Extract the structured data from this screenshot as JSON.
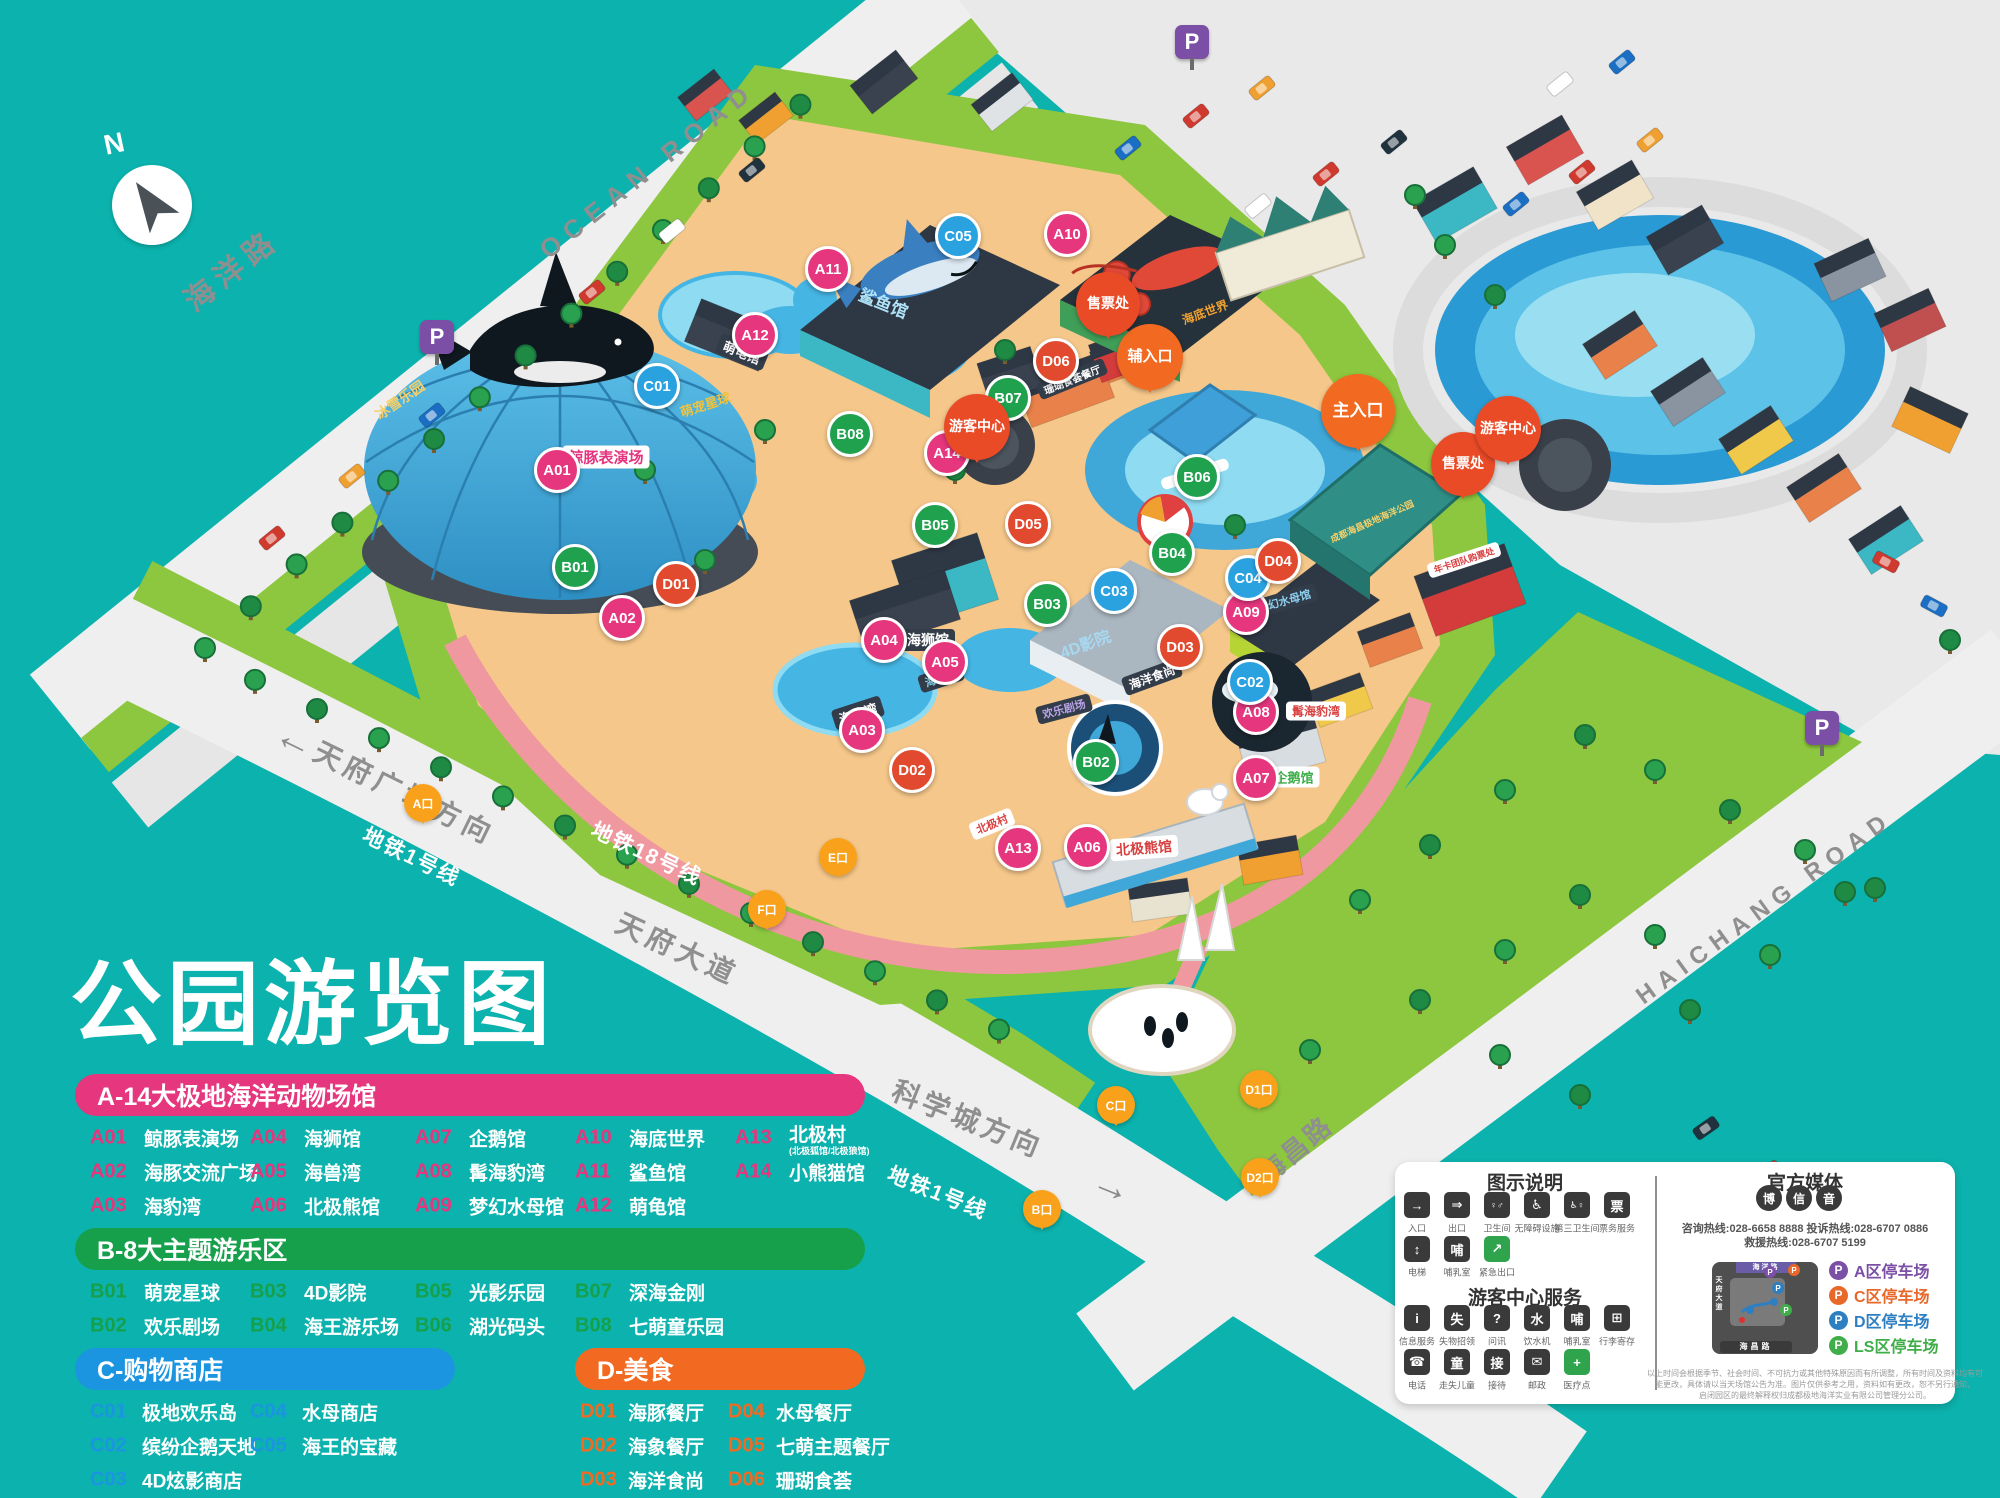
{
  "title": "公园游览图",
  "compass": {
    "north_label": "N"
  },
  "roads": {
    "ocean_road_cn": "海洋路",
    "ocean_road_en": "OCEAN ROAD",
    "haichang_road_cn": "海昌路",
    "haichang_road_en": "HAICHANG ROAD",
    "tianfu_avenue": "天府大道",
    "tianfu_square_direction": "天府广场方向",
    "science_city_direction": "科学城方向",
    "metro_line1": "地铁1号线",
    "metro_line18": "地铁18号线"
  },
  "map": {
    "marker_colors": {
      "A": "#e5367e",
      "B": "#1fa14e",
      "C": "#2aa2e0",
      "D": "#e14a2e"
    },
    "balloons": [
      {
        "label": "主入口",
        "x": 1358,
        "y": 448,
        "kind": "entrance",
        "size": 66,
        "fs": 17
      },
      {
        "label": "辅入口",
        "x": 1150,
        "y": 390,
        "kind": "entrance",
        "size": 58,
        "fs": 15
      },
      {
        "label": "售票处",
        "x": 1463,
        "y": 496,
        "kind": "service",
        "size": 56,
        "fs": 14
      },
      {
        "label": "售票处",
        "x": 1108,
        "y": 336,
        "kind": "service",
        "size": 56,
        "fs": 14
      },
      {
        "label": "游客中心",
        "x": 1508,
        "y": 462,
        "kind": "service",
        "size": 58,
        "fs": 14
      },
      {
        "label": "游客中心",
        "x": 977,
        "y": 460,
        "kind": "service",
        "size": 58,
        "fs": 14
      }
    ],
    "metro_exits": [
      {
        "label": "A口",
        "x": 423,
        "y": 822
      },
      {
        "label": "B口",
        "x": 1042,
        "y": 1228
      },
      {
        "label": "C口",
        "x": 1116,
        "y": 1124
      },
      {
        "label": "D1口",
        "x": 1259,
        "y": 1108
      },
      {
        "label": "D2口",
        "x": 1260,
        "y": 1196
      },
      {
        "label": "E口",
        "x": 838,
        "y": 876
      },
      {
        "label": "F口",
        "x": 767,
        "y": 928
      }
    ],
    "parking_signs": [
      {
        "label": "P",
        "x": 1192,
        "y": 42
      },
      {
        "label": "P",
        "x": 437,
        "y": 337
      },
      {
        "label": "P",
        "x": 1822,
        "y": 728
      }
    ],
    "markers": [
      {
        "code": "A01",
        "cat": "A",
        "x": 557,
        "y": 470
      },
      {
        "code": "A02",
        "cat": "A",
        "x": 622,
        "y": 618
      },
      {
        "code": "A03",
        "cat": "A",
        "x": 862,
        "y": 730
      },
      {
        "code": "A04",
        "cat": "A",
        "x": 884,
        "y": 640
      },
      {
        "code": "A05",
        "cat": "A",
        "x": 945,
        "y": 662
      },
      {
        "code": "A06",
        "cat": "A",
        "x": 1087,
        "y": 847
      },
      {
        "code": "A07",
        "cat": "A",
        "x": 1256,
        "y": 778
      },
      {
        "code": "A08",
        "cat": "A",
        "x": 1256,
        "y": 712
      },
      {
        "code": "A09",
        "cat": "A",
        "x": 1246,
        "y": 612
      },
      {
        "code": "A10",
        "cat": "A",
        "x": 1067,
        "y": 234
      },
      {
        "code": "A11",
        "cat": "A",
        "x": 828,
        "y": 269
      },
      {
        "code": "A12",
        "cat": "A",
        "x": 755,
        "y": 335
      },
      {
        "code": "A13",
        "cat": "A",
        "x": 1018,
        "y": 848
      },
      {
        "code": "A14",
        "cat": "A",
        "x": 947,
        "y": 453
      },
      {
        "code": "B01",
        "cat": "B",
        "x": 575,
        "y": 567
      },
      {
        "code": "B02",
        "cat": "B",
        "x": 1096,
        "y": 762
      },
      {
        "code": "B03",
        "cat": "B",
        "x": 1047,
        "y": 604
      },
      {
        "code": "B04",
        "cat": "B",
        "x": 1172,
        "y": 553
      },
      {
        "code": "B05",
        "cat": "B",
        "x": 935,
        "y": 525
      },
      {
        "code": "B06",
        "cat": "B",
        "x": 1197,
        "y": 477
      },
      {
        "code": "B07",
        "cat": "B",
        "x": 1008,
        "y": 398
      },
      {
        "code": "B08",
        "cat": "B",
        "x": 850,
        "y": 434
      },
      {
        "code": "C01",
        "cat": "C",
        "x": 657,
        "y": 386
      },
      {
        "code": "C02",
        "cat": "C",
        "x": 1250,
        "y": 682
      },
      {
        "code": "C03",
        "cat": "C",
        "x": 1114,
        "y": 591
      },
      {
        "code": "C04",
        "cat": "C",
        "x": 1248,
        "y": 578
      },
      {
        "code": "C05",
        "cat": "C",
        "x": 958,
        "y": 236
      },
      {
        "code": "D01",
        "cat": "D",
        "x": 676,
        "y": 584
      },
      {
        "code": "D02",
        "cat": "D",
        "x": 912,
        "y": 770
      },
      {
        "code": "D03",
        "cat": "D",
        "x": 1180,
        "y": 647
      },
      {
        "code": "D04",
        "cat": "D",
        "x": 1278,
        "y": 561
      },
      {
        "code": "D05",
        "cat": "D",
        "x": 1028,
        "y": 524
      },
      {
        "code": "D06",
        "cat": "D",
        "x": 1056,
        "y": 361
      }
    ],
    "signs": [
      {
        "text": "鲸豚表演场",
        "x": 606,
        "y": 457,
        "rot": 0,
        "fg": "#e6357f",
        "bg": "#ffffff",
        "fs": 15
      },
      {
        "text": "冰雪乐园",
        "x": 400,
        "y": 400,
        "rot": -35,
        "fg": "#f5d06a",
        "bg": "",
        "fs": 14
      },
      {
        "text": "萌宠星球",
        "x": 705,
        "y": 404,
        "rot": -18,
        "fg": "#f0c23e",
        "bg": "",
        "fs": 13
      },
      {
        "text": "萌龟馆",
        "x": 742,
        "y": 352,
        "rot": 22,
        "fg": "#ffffff",
        "bg": "#333d4a",
        "fs": 13
      },
      {
        "text": "鲨鱼馆",
        "x": 884,
        "y": 302,
        "rot": 22,
        "fg": "#aee2f7",
        "bg": "",
        "fs": 17
      },
      {
        "text": "海底世界",
        "x": 1205,
        "y": 312,
        "rot": -20,
        "fg": "#f0a030",
        "bg": "",
        "fs": 12
      },
      {
        "text": "海狮馆",
        "x": 928,
        "y": 640,
        "rot": 0,
        "fg": "#ffffff",
        "bg": "#333d4a",
        "fs": 14
      },
      {
        "text": "海兽湾",
        "x": 941,
        "y": 678,
        "rot": -18,
        "fg": "#8edbf2",
        "bg": "#333d4a",
        "fs": 11
      },
      {
        "text": "海豹湾",
        "x": 858,
        "y": 713,
        "rot": -18,
        "fg": "#ffffff",
        "bg": "#333d4a",
        "fs": 13
      },
      {
        "text": "4D影院",
        "x": 1085,
        "y": 643,
        "rot": -20,
        "fg": "#a8d8f0",
        "bg": "",
        "fs": 16
      },
      {
        "text": "海洋食尚",
        "x": 1152,
        "y": 677,
        "rot": -20,
        "fg": "#ffffff",
        "bg": "#333d4a",
        "fs": 12
      },
      {
        "text": "梦幻水母馆",
        "x": 1284,
        "y": 601,
        "rot": -16,
        "fg": "#8ed0f0",
        "bg": "#333d4a",
        "fs": 11
      },
      {
        "text": "欢乐剧场",
        "x": 1064,
        "y": 709,
        "rot": -15,
        "fg": "#b9a3e8",
        "bg": "#333d4a",
        "fs": 11
      },
      {
        "text": "企鹅馆",
        "x": 1294,
        "y": 777,
        "rot": 0,
        "fg": "#3fae49",
        "bg": "#ffffff",
        "fs": 13
      },
      {
        "text": "髯海豹湾",
        "x": 1316,
        "y": 711,
        "rot": 0,
        "fg": "#d94040",
        "bg": "#ffffff",
        "fs": 12
      },
      {
        "text": "北极熊馆",
        "x": 1144,
        "y": 848,
        "rot": -4,
        "fg": "#d94040",
        "bg": "#ffffff",
        "fs": 14
      },
      {
        "text": "北极村",
        "x": 992,
        "y": 824,
        "rot": -22,
        "fg": "#d94040",
        "bg": "#ffffff",
        "fs": 11
      },
      {
        "text": "珊瑚食荟餐厅",
        "x": 1072,
        "y": 379,
        "rot": -22,
        "fg": "#ffffff",
        "bg": "#333d4a",
        "fs": 10
      },
      {
        "text": "成都海昌极地海洋公园",
        "x": 1372,
        "y": 521,
        "rot": -24,
        "fg": "#f5d06a",
        "bg": "",
        "fs": 9
      },
      {
        "text": "年卡团队购票处",
        "x": 1464,
        "y": 560,
        "rot": -18,
        "fg": "#d94040",
        "bg": "#ffffff",
        "fs": 9
      }
    ]
  },
  "legend": {
    "sections": [
      {
        "id": "A",
        "title": "A-14大极地海洋动物场馆",
        "color": "#e5367e",
        "x": 75,
        "y": 1074,
        "width": 790,
        "rows": 3,
        "cols": [
          15,
          175,
          340,
          500,
          660
        ],
        "name_offset": 54,
        "items": [
          {
            "code": "A01",
            "name": "鲸豚表演场"
          },
          {
            "code": "A02",
            "name": "海豚交流广场"
          },
          {
            "code": "A03",
            "name": "海豹湾"
          },
          {
            "code": "A04",
            "name": "海狮馆"
          },
          {
            "code": "A05",
            "name": "海兽湾"
          },
          {
            "code": "A06",
            "name": "北极熊馆"
          },
          {
            "code": "A07",
            "name": "企鹅馆"
          },
          {
            "code": "A08",
            "name": "髯海豹湾"
          },
          {
            "code": "A09",
            "name": "梦幻水母馆"
          },
          {
            "code": "A10",
            "name": "海底世界"
          },
          {
            "code": "A11",
            "name": "鲨鱼馆"
          },
          {
            "code": "A12",
            "name": "萌龟馆"
          },
          {
            "code": "A13",
            "name": "北极村",
            "note": "(北极狐馆/北极狼馆)"
          },
          {
            "code": "A14",
            "name": "小熊猫馆"
          }
        ]
      },
      {
        "id": "B",
        "title": "B-8大主题游乐区",
        "color": "#16a04c",
        "x": 75,
        "y": 1228,
        "width": 790,
        "rows": 2,
        "cols": [
          15,
          175,
          340,
          500
        ],
        "name_offset": 54,
        "items": [
          {
            "code": "B01",
            "name": "萌宠星球"
          },
          {
            "code": "B02",
            "name": "欢乐剧场"
          },
          {
            "code": "B03",
            "name": "4D影院"
          },
          {
            "code": "B04",
            "name": "海王游乐场"
          },
          {
            "code": "B05",
            "name": "光影乐园"
          },
          {
            "code": "B06",
            "name": "湖光码头"
          },
          {
            "code": "B07",
            "name": "深海金刚"
          },
          {
            "code": "B08",
            "name": "七萌童乐园"
          }
        ]
      },
      {
        "id": "C",
        "title": "C-购物商店",
        "color": "#1b95e0",
        "x": 75,
        "y": 1348,
        "width": 380,
        "rows": 3,
        "cols": [
          15,
          175
        ],
        "name_offset": 52,
        "items": [
          {
            "code": "C01",
            "name": "极地欢乐岛"
          },
          {
            "code": "C02",
            "name": "缤纷企鹅天地"
          },
          {
            "code": "C03",
            "name": "4D炫影商店"
          },
          {
            "code": "C04",
            "name": "水母商店"
          },
          {
            "code": "C05",
            "name": "海王的宝藏"
          }
        ]
      },
      {
        "id": "D",
        "title": "D-美食",
        "color": "#f26a21",
        "x": 575,
        "y": 1348,
        "width": 290,
        "rows": 3,
        "cols": [
          5,
          153
        ],
        "name_offset": 48,
        "items": [
          {
            "code": "D01",
            "name": "海豚餐厅"
          },
          {
            "code": "D02",
            "name": "海象餐厅"
          },
          {
            "code": "D03",
            "name": "海洋食尚"
          },
          {
            "code": "D04",
            "name": "水母餐厅"
          },
          {
            "code": "D05",
            "name": "七萌主题餐厅"
          },
          {
            "code": "D06",
            "name": "珊瑚食荟"
          }
        ]
      }
    ]
  },
  "panel": {
    "icon_legend": {
      "title": "图示说明",
      "items": [
        {
          "icon": "entrance-icon",
          "glyph": "→",
          "label": "入口"
        },
        {
          "icon": "exit-icon",
          "glyph": "⇒",
          "label": "出口"
        },
        {
          "icon": "restroom-icon",
          "glyph": "♀♂",
          "label": "卫生间"
        },
        {
          "icon": "accessible-icon",
          "glyph": "♿",
          "label": "无障碍设施"
        },
        {
          "icon": "third-restroom-icon",
          "glyph": "♿♀",
          "label": "第三卫生间"
        },
        {
          "icon": "ticket-service-icon",
          "glyph": "票",
          "label": "票务服务"
        },
        {
          "icon": "elevator-icon",
          "glyph": "↕",
          "label": "电梯"
        },
        {
          "icon": "nursing-room-icon",
          "glyph": "哺",
          "label": "哺乳室"
        },
        {
          "icon": "emergency-exit-icon",
          "glyph": "↗",
          "label": "紧急出口",
          "green": true
        }
      ]
    },
    "services": {
      "title": "游客中心服务",
      "items": [
        {
          "icon": "information-icon",
          "glyph": "i",
          "label": "信息服务"
        },
        {
          "icon": "lost-found-icon",
          "glyph": "失",
          "label": "失物招领"
        },
        {
          "icon": "inquiry-icon",
          "glyph": "?",
          "label": "问讯"
        },
        {
          "icon": "water-dispenser-icon",
          "glyph": "水",
          "label": "饮水机"
        },
        {
          "icon": "nursing-room-icon",
          "glyph": "哺",
          "label": "哺乳室"
        },
        {
          "icon": "luggage-storage-icon",
          "glyph": "⊞",
          "label": "行李寄存"
        },
        {
          "icon": "telephone-icon",
          "glyph": "☎",
          "label": "电话"
        },
        {
          "icon": "lost-child-icon",
          "glyph": "童",
          "label": "走失儿童"
        },
        {
          "icon": "reception-icon",
          "glyph": "接",
          "label": "接待"
        },
        {
          "icon": "post-icon",
          "glyph": "✉",
          "label": "邮政"
        },
        {
          "icon": "medical-icon",
          "glyph": "+",
          "label": "医疗点",
          "green": true
        }
      ]
    },
    "media": {
      "title": "官方媒体",
      "icons": [
        {
          "icon": "weibo-icon",
          "glyph": "博"
        },
        {
          "icon": "wechat-icon",
          "glyph": "信"
        },
        {
          "icon": "douyin-icon",
          "glyph": "音"
        }
      ]
    },
    "hotlines": [
      "咨询热线:028-6658 8888",
      "投诉热线:028-6707 0886",
      "救援热线:028-6707 5199"
    ],
    "minimap": {
      "top_road": "海洋路",
      "left_road": "天府大道",
      "bottom_road": "海昌路"
    },
    "parking": [
      {
        "label": "A区停车场",
        "color": "#7b4fa6"
      },
      {
        "label": "C区停车场",
        "color": "#e8682a"
      },
      {
        "label": "D区停车场",
        "color": "#2e7fc2"
      },
      {
        "label": "LS区停车场",
        "color": "#3fae49"
      }
    ],
    "disclaimer": [
      "以上时间会根据季节、社会时间、不可抗力或其他特殊原因而有所调整，所有时间及资料均有可",
      "能更改，具体请以当天场馆公告为准。图片仅供参考之用，资料如有更改，恕不另行通知，",
      "启闭园区的最终解释权归成都极地海洋实业有限公司管理分公司。"
    ]
  }
}
